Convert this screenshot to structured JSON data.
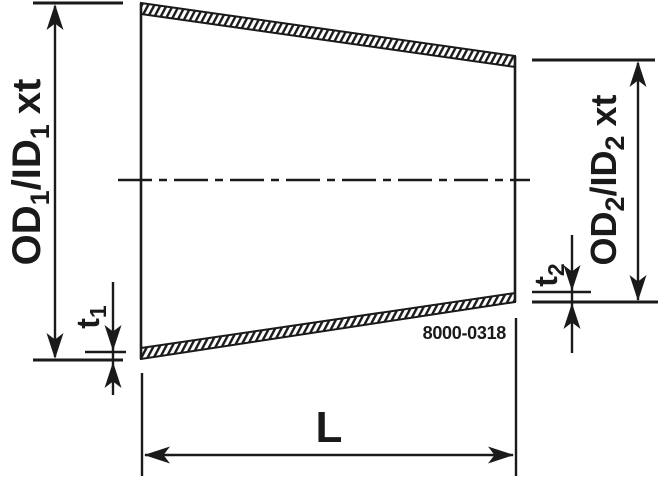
{
  "drawing": {
    "part_number": "8000-0318",
    "labels": {
      "dim_left": {
        "prefix": "OD",
        "prefix_sub": "1",
        "mid": "/ID",
        "mid_sub": "1",
        "suffix": "xt"
      },
      "dim_right": {
        "prefix": "OD",
        "prefix_sub": "2",
        "mid": "/ID",
        "mid_sub": "2",
        "suffix": "xt"
      },
      "dim_t1": {
        "main": "t",
        "sub": "1"
      },
      "dim_t2": {
        "main": "t",
        "sub": "2"
      },
      "dim_length": "L"
    },
    "colors": {
      "ink": "#1a1a1a",
      "background": "#ffffff"
    }
  }
}
